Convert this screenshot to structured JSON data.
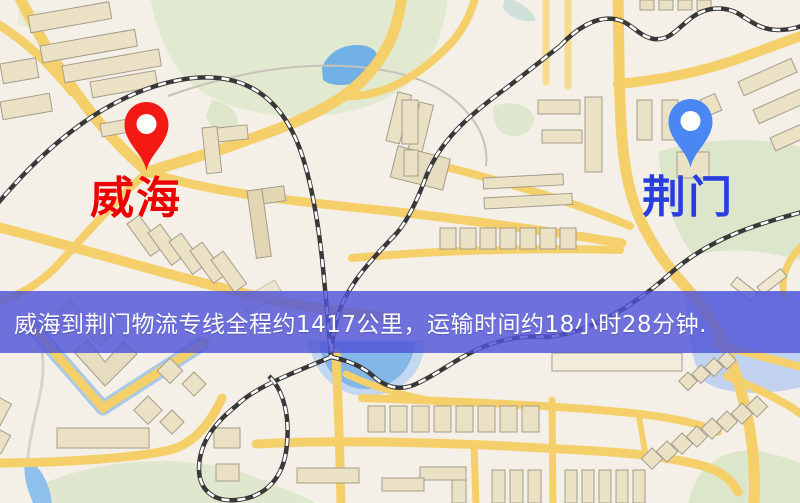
{
  "map": {
    "origin": {
      "label": "威海",
      "pin_color": "#ed1c16",
      "label_color": "#e80000"
    },
    "destination": {
      "label": "荆门",
      "pin_color": "#4d87ef",
      "label_color": "#2b3ed8"
    }
  },
  "banner": {
    "text": "威海到荆门物流专线全程约1417公里，运输时间约18小时28分钟.",
    "background_color": "#5054d3",
    "text_color": "#ffffff",
    "route": {
      "from": "威海",
      "to": "荆门",
      "distance": "约1417公里",
      "duration": "约18小时28分钟"
    }
  }
}
